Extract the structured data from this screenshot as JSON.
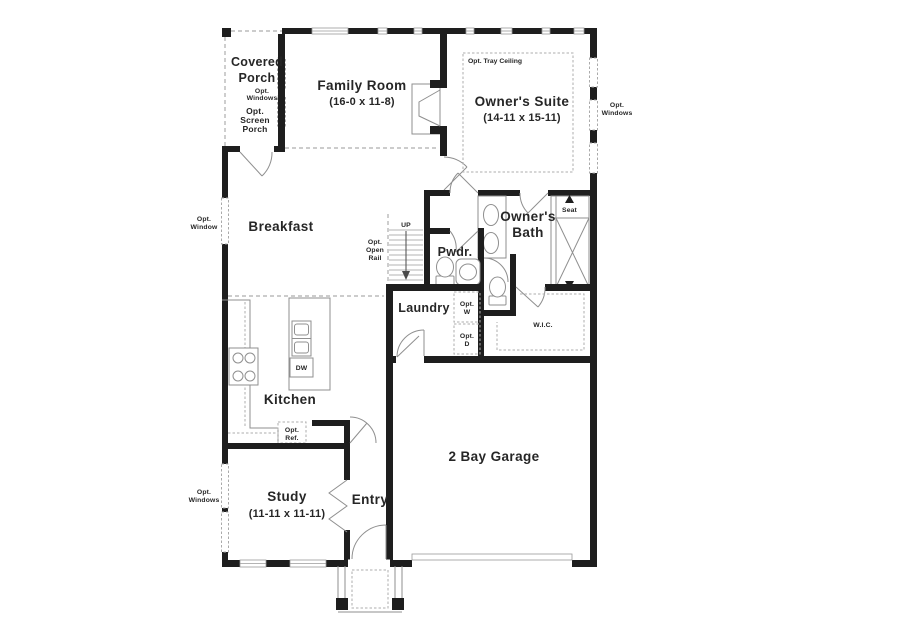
{
  "colors": {
    "wall": "#1e1e1e",
    "fixture": "#8f8f8f",
    "dashed": "#aeaeae",
    "text": "#262626",
    "bg": "#ffffff"
  },
  "rooms": {
    "covered_porch": {
      "name_1": "Covered",
      "name_2": "Porch",
      "opt_windows_1": "Opt.",
      "opt_windows_2": "Windows",
      "opt_screen_1": "Opt.",
      "opt_screen_2": "Screen",
      "opt_screen_3": "Porch"
    },
    "family_room": {
      "name": "Family Room",
      "dims": "(16-0 x 11-8)"
    },
    "owners_suite": {
      "name": "Owner's Suite",
      "dims": "(14-11 x 15-11)",
      "tray_note": "Opt. Tray Ceiling",
      "opt_windows_1": "Opt.",
      "opt_windows_2": "Windows"
    },
    "owners_bath": {
      "name_1": "Owner's",
      "name_2": "Bath",
      "seat": "Seat"
    },
    "wic": {
      "name": "W.I.C."
    },
    "pwdr": {
      "name": "Pwdr."
    },
    "laundry": {
      "name": "Laundry",
      "washer_1": "Opt.",
      "washer_2": "W",
      "dryer_1": "Opt.",
      "dryer_2": "D"
    },
    "breakfast": {
      "name": "Breakfast",
      "opt_window_1": "Opt.",
      "opt_window_2": "Window"
    },
    "kitchen": {
      "name": "Kitchen",
      "dishwasher": "DW",
      "opt_ref_1": "Opt.",
      "opt_ref_2": "Ref."
    },
    "stairs": {
      "up": "UP",
      "rail_1": "Opt.",
      "rail_2": "Open",
      "rail_3": "Rail"
    },
    "study": {
      "name": "Study",
      "dims": "(11-11 x 11-11)",
      "opt_windows_1": "Opt.",
      "opt_windows_2": "Windows"
    },
    "entry": {
      "name": "Entry"
    },
    "garage": {
      "name": "2 Bay Garage"
    }
  }
}
